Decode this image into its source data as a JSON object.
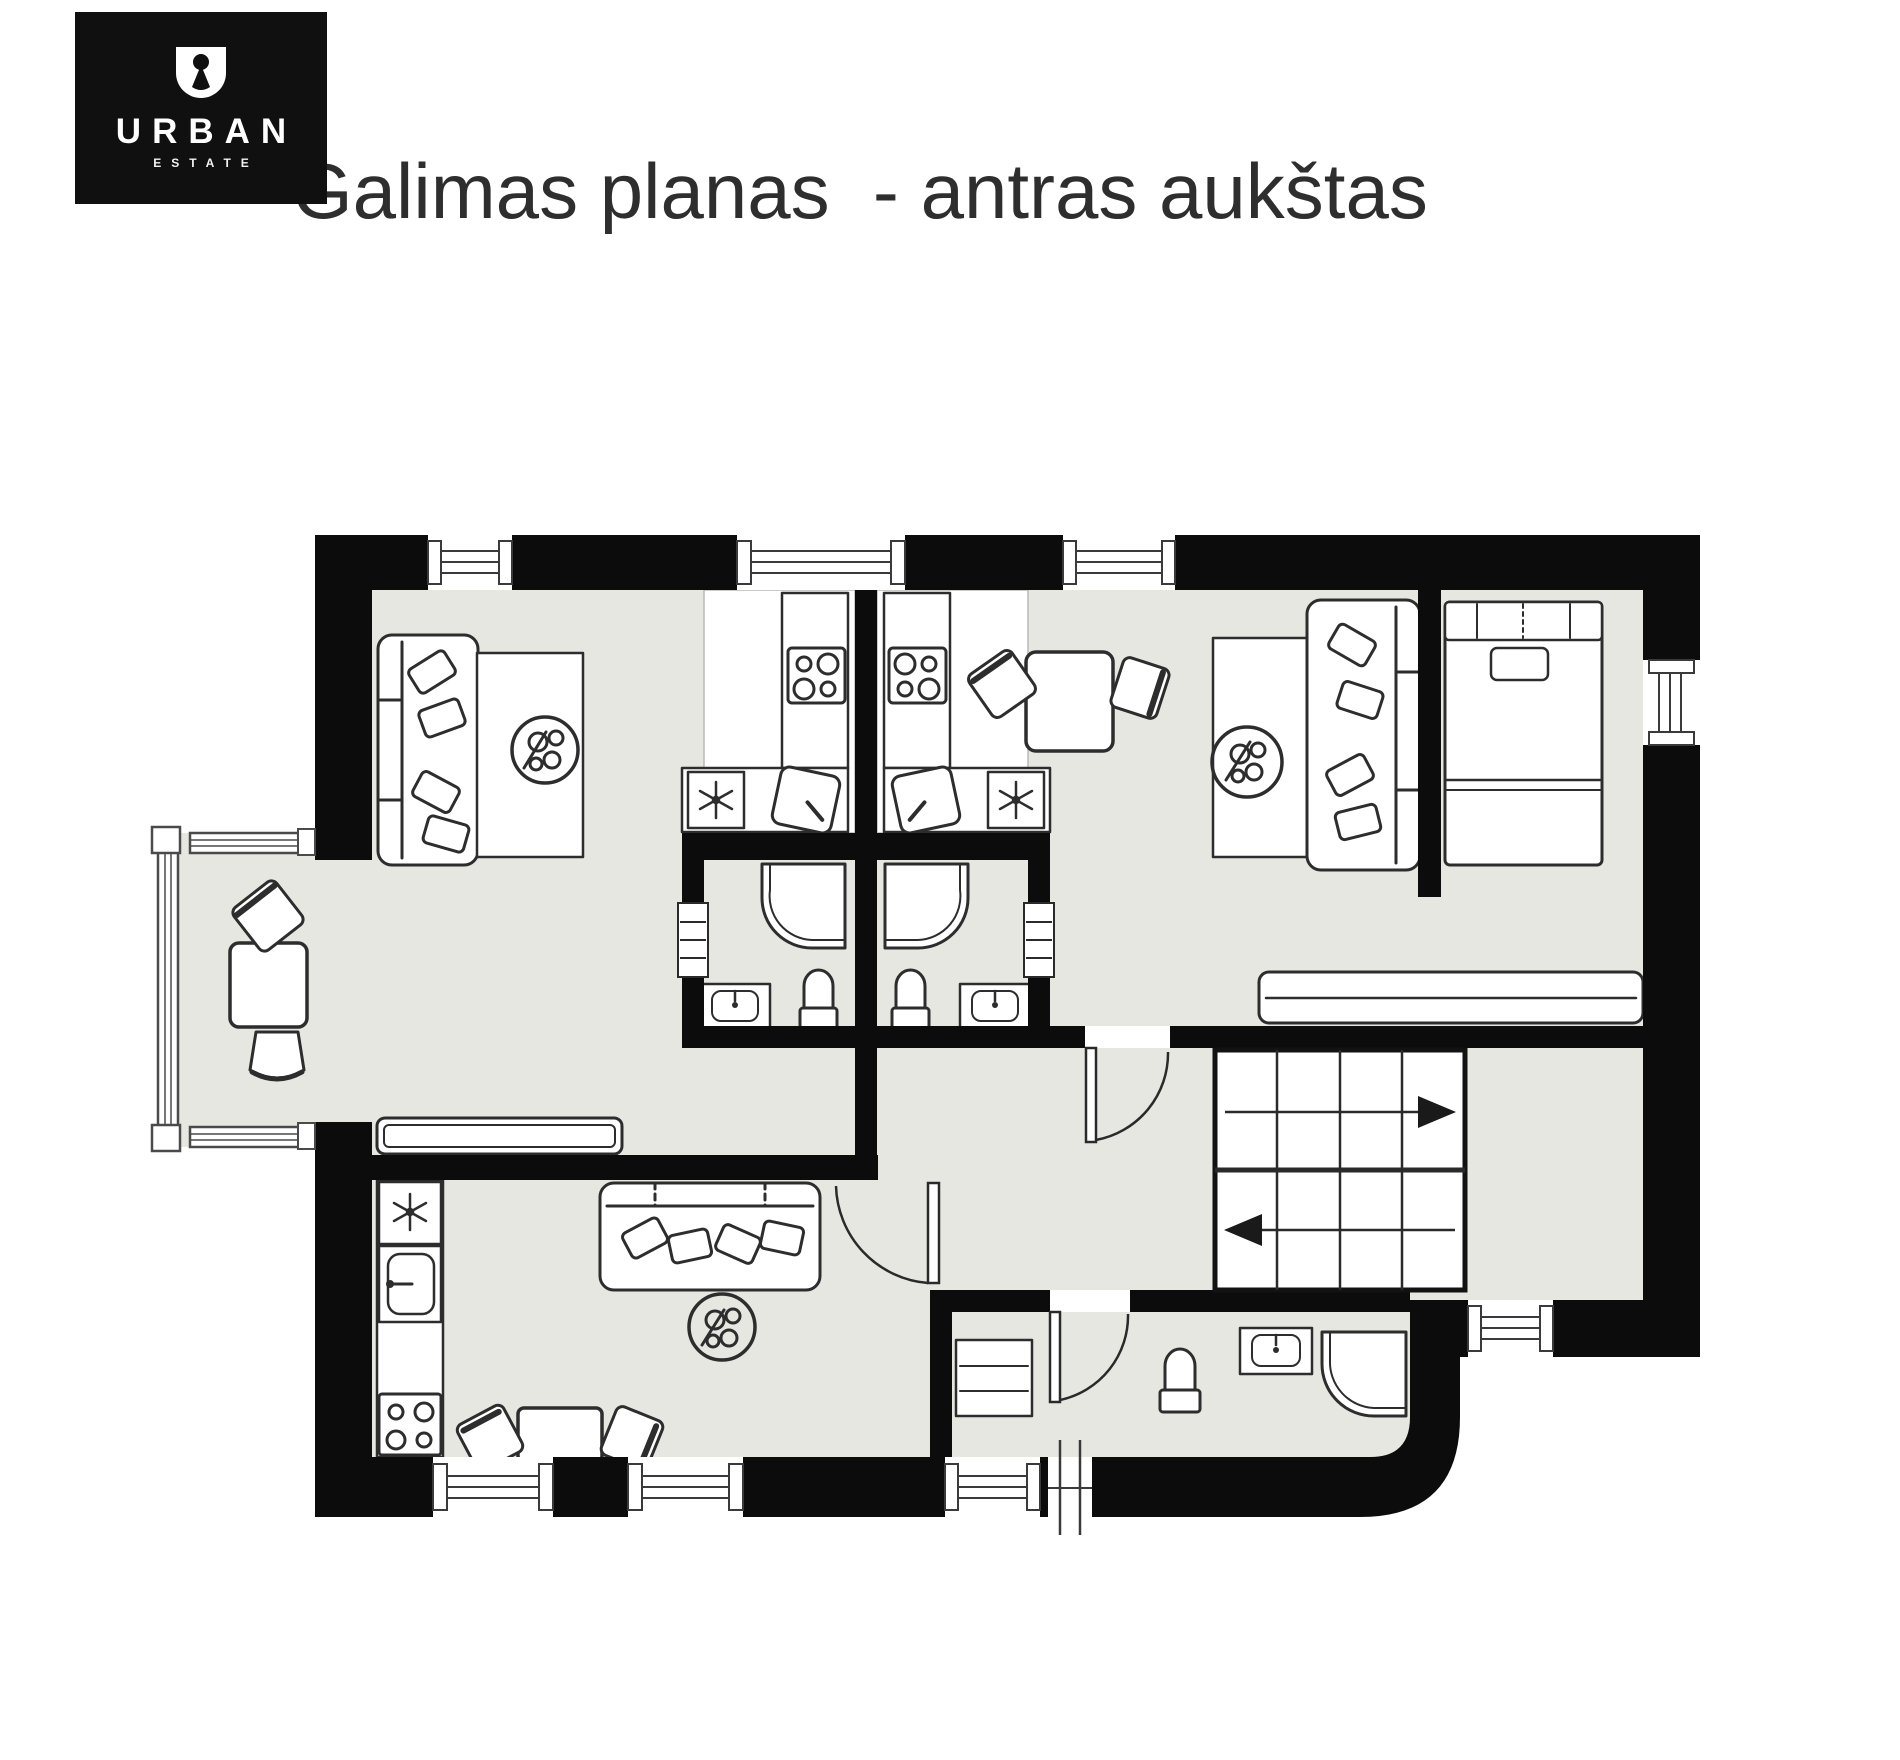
{
  "logo": {
    "brand": "URBAN",
    "sub": "ESTATE",
    "icon": "keyhole-u-icon"
  },
  "title": "Galimas planas  - antras aukštas",
  "colors": {
    "background": "#ffffff",
    "wall": "#0c0c0c",
    "floor": "#e7e7e2",
    "kitchen_floor": "#ffffff",
    "furniture_outline": "#2d2d2d",
    "logo_bg": "#101010",
    "title_color": "#2e2e2e"
  },
  "floorplan": {
    "stairs": {
      "upper_arrow": "right",
      "lower_arrow": "left",
      "flights": 2
    },
    "window_icons": [
      "top-window-1",
      "top-window-2",
      "top-window-3",
      "right-window",
      "bottom-window-1",
      "bottom-window-2",
      "bottom-window-3",
      "stair-hall-window",
      "balcony-glazing",
      "service-door-mark"
    ],
    "door_icons": [
      "bathroom-1-door",
      "bathroom-2-door",
      "hall-door",
      "living-room-door",
      "bottom-bathroom-door"
    ],
    "furniture_icons": [
      "sofa-icon",
      "coffee-table-icon",
      "plant-icon",
      "sideboard-icon",
      "stove-icon",
      "fridge-snowflake-icon",
      "kitchen-sink-icon",
      "shower-icon",
      "toilet-icon",
      "washbasin-icon",
      "bed-icon",
      "wardrobe-icon",
      "desk-icon",
      "chair-icon",
      "dining-table-icon",
      "washing-machine-icon",
      "stairs-icon"
    ]
  }
}
